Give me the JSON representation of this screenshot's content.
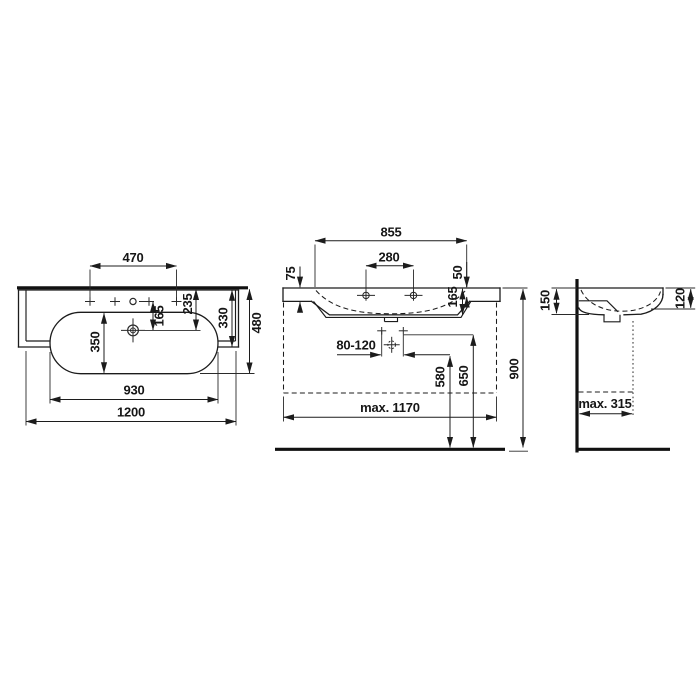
{
  "drawing": {
    "type": "technical-dimension-drawing",
    "subject": "wall-mounted washbasin, three orthographic views",
    "background": "#ffffff",
    "line_color": "#1c1c1c",
    "views": {
      "plan": {
        "label": "top view",
        "dims": {
          "tap_hole_spread": "470",
          "tap_to_drain": "165",
          "back_to_drain": "235",
          "counter_depth": "330",
          "total_depth": "480",
          "bowl_depth": "350",
          "bowl_width": "930",
          "total_width": "1200"
        }
      },
      "front": {
        "label": "front view",
        "dims": {
          "inner_width": "855",
          "tap_hole_distance": "280",
          "front_edge_height": "75",
          "tap_offset": "50",
          "basin_inner_depth": "165",
          "outlet_range": "80-120",
          "trap_height": "580",
          "outlet_height": "650",
          "mounting_height": "900",
          "max_clear_width": "max. 1170"
        }
      },
      "side": {
        "label": "side view",
        "dims": {
          "wall_edge_height": "150",
          "front_apron_height": "120",
          "max_clear_depth": "max. 315"
        }
      }
    }
  }
}
